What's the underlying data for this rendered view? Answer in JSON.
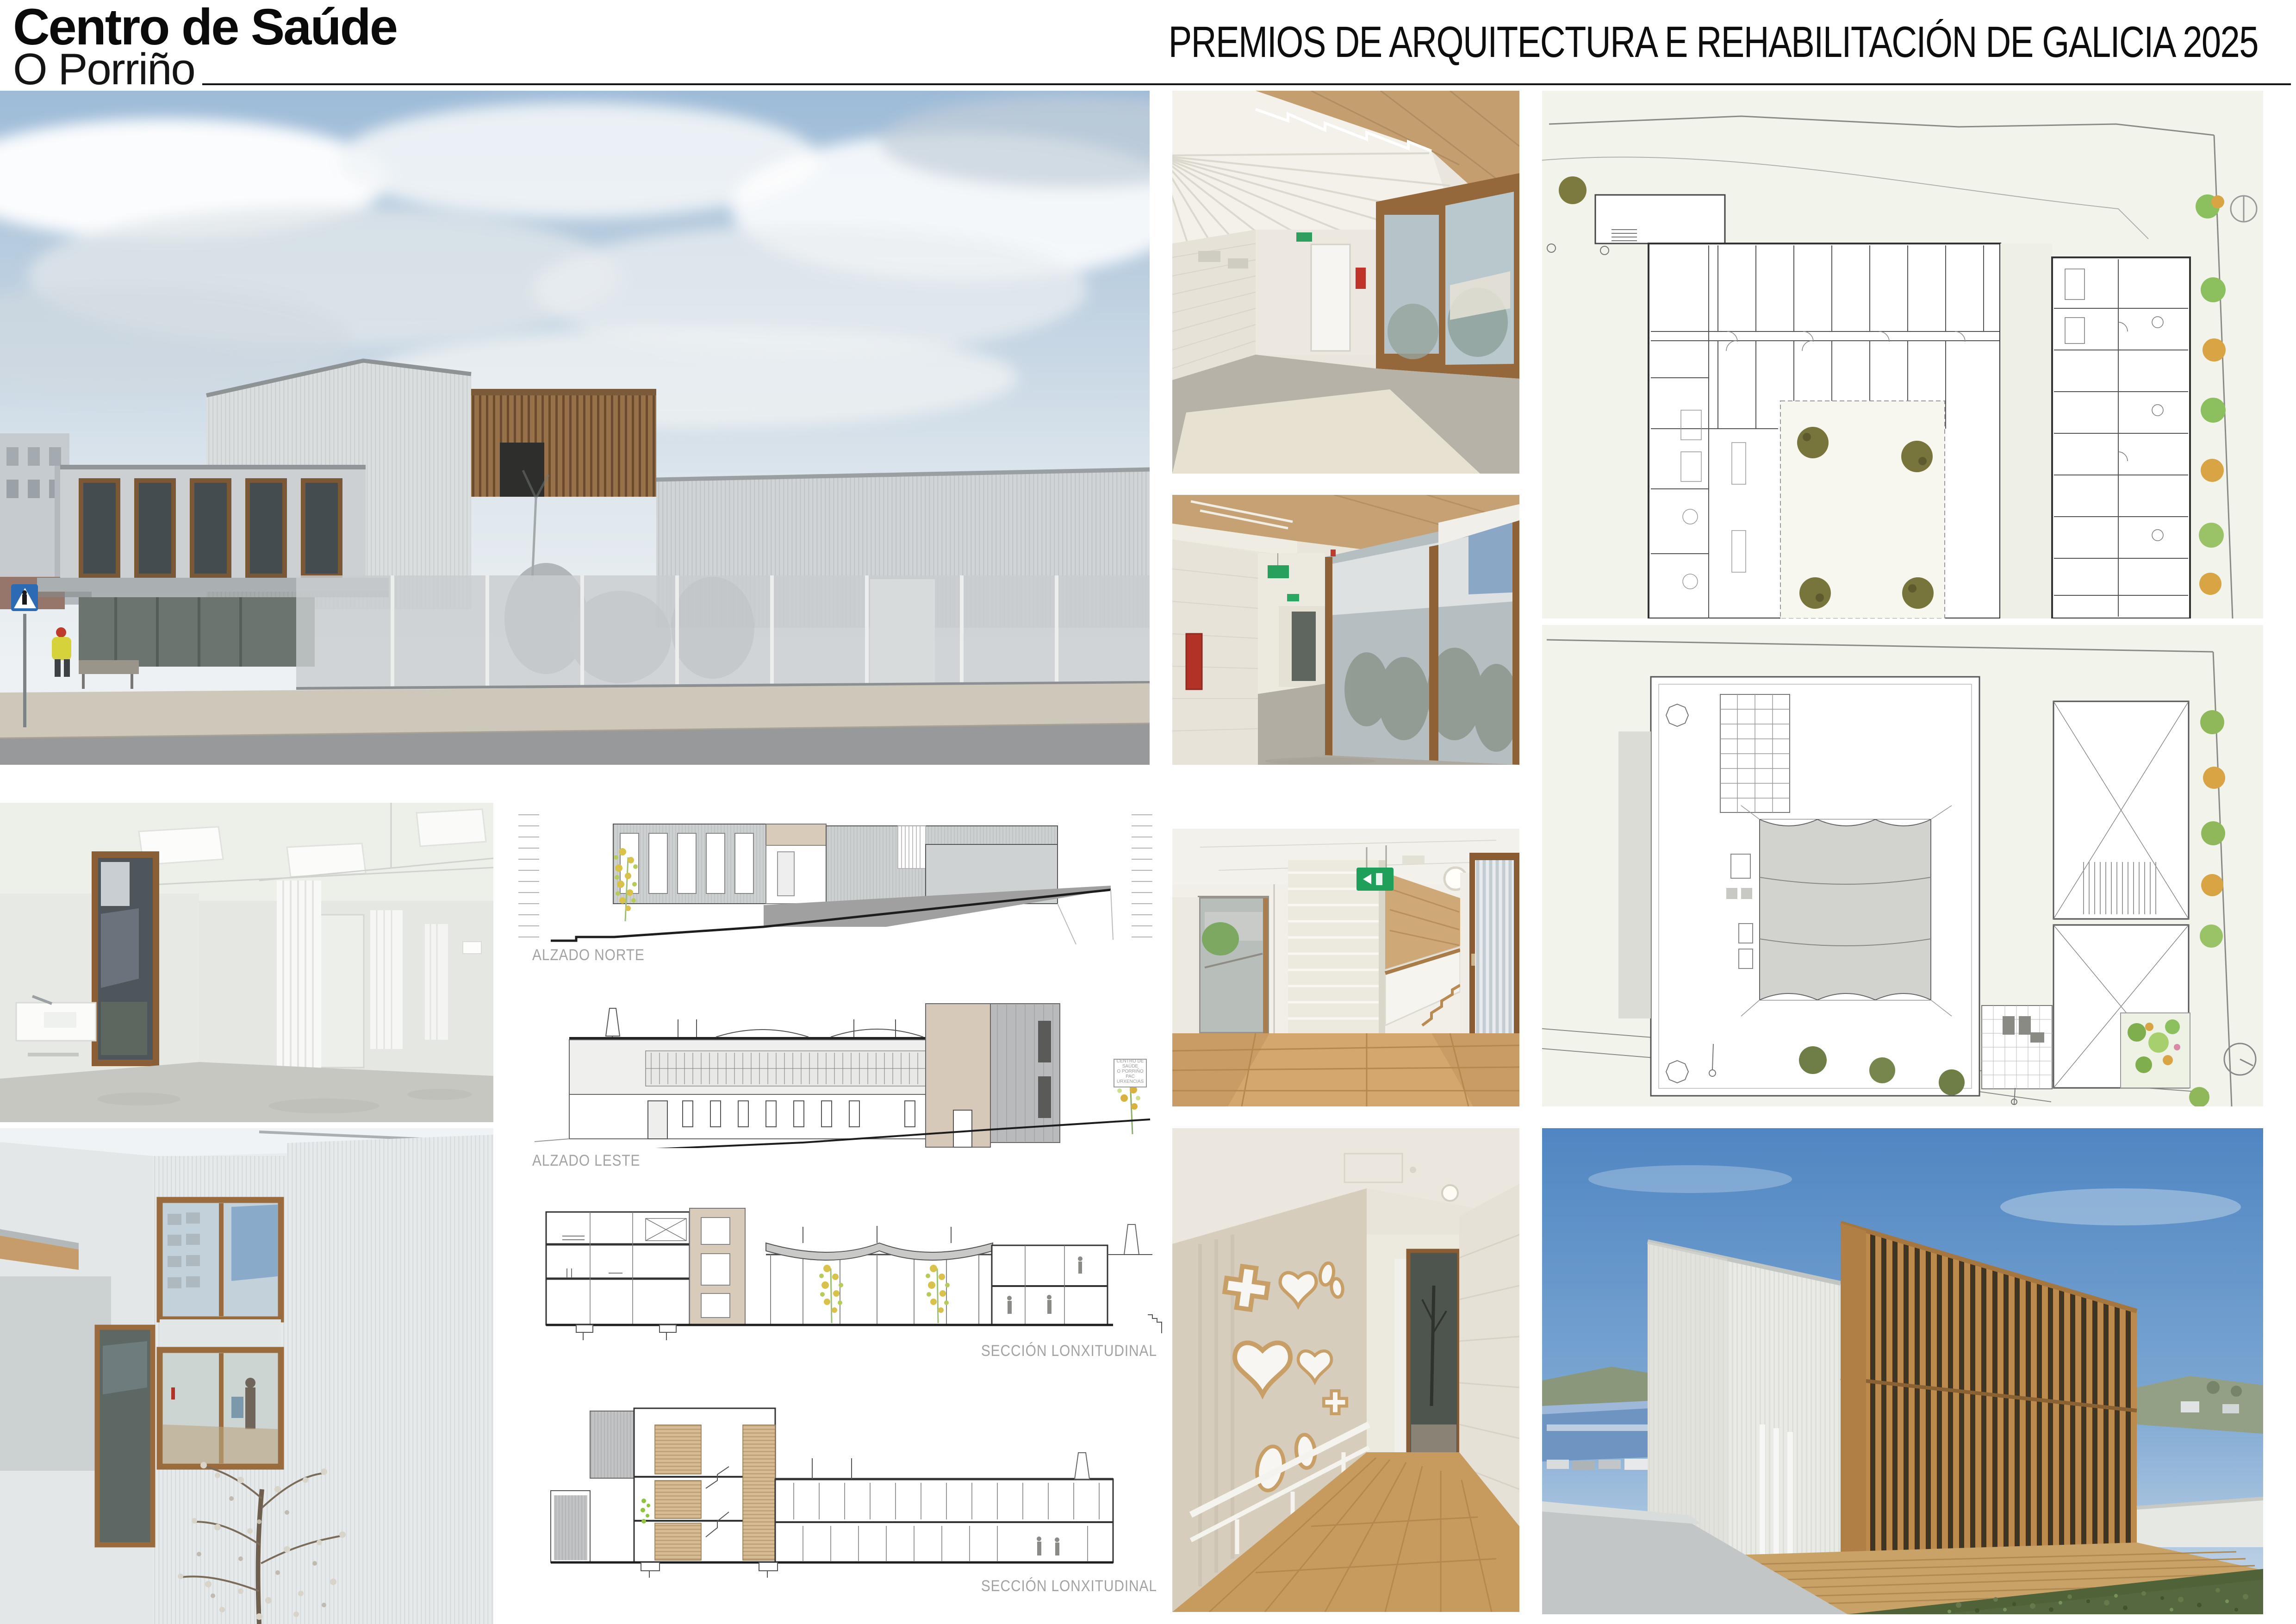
{
  "header": {
    "project_title": "Centro de Saúde",
    "project_subtitle": "O Porriño",
    "award_title": "PREMIOS DE ARQUITECTURA E REHABILITACIÓN DE GALICIA 2025"
  },
  "project_info": {
    "rows": [
      {
        "label": "Situación",
        "value": "_ Rúa Tranvía, s/n. O Porriño (Pontevedra)",
        "bold": true
      },
      {
        "label": "Superficie",
        "value": "_ 2.703 m²",
        "bold": true
      },
      {
        "label": "Finalización",
        "value": "_outubro de 2023",
        "bold": true
      },
      {
        "label": "PEM",
        "value": "_ 4.007.237 €",
        "bold": true
      },
      {
        "label": "Promotor",
        "value": "_SERGAS Servicio Galego de Saúde",
        "bold": true
      },
      {
        "label": "Autoras",
        "value": "_Cristina Ezcurra, Cristina Ouzande",
        "bold": true
      },
      {
        "label": "Colaboradores",
        "value": "_Sandra Arcos, Belén Riande, Julio Pedreira, Néstor Rancaño",
        "bold": true
      },
      {
        "label": "Cálculo estructuras",
        "value": "_David Robles Redondo, Veta Ingeniería",
        "bold": true
      },
      {
        "label": "Enxeñería de instalacións",
        "value": "_Nortap Ingenieros S.L.",
        "bold": false
      },
      {
        "label": "Enxeñería telecomunicacións",
        "value": "_Gehon Consulting S.L.",
        "bold": false
      },
      {
        "label": "Dirección de obra",
        "value": "_Cristina Ezcurra, Cristina Ouzande",
        "bold": true
      },
      {
        "label": "Dirección de execución",
        "value": "_Antonio Carballo Couñago",
        "bold": true
      },
      {
        "label": "Coordinador de Seguridad y Salud",
        "value": "_Luis Ángel Fernández Neira",
        "bold": false
      },
      {
        "label": "Constructora",
        "value": "_COPASA",
        "bold": true
      }
    ]
  },
  "drawing_labels": {
    "alzado_norte": "ALZADO NORTE",
    "alzado_leste": "ALZADO LESTE",
    "seccion_1": "SECCIÓN LONXITUDINAL",
    "seccion_2": "SECCIÓN LONXITUDINAL"
  },
  "leste_sign": {
    "lines": [
      "CENTRO DE",
      "SAÚDE",
      "O PORRIÑO",
      "PAC",
      "URXENCIAS"
    ]
  },
  "colors": {
    "exit_sign_green": "#1fa05a",
    "fire_equipment_red": "#bf3328",
    "timber_wood": "#b9854a",
    "sky_blue": "#5b8fc7",
    "plan_site_green": "#f2f4ec",
    "drawing_label_gray": "#a3a3a3",
    "elevation_beige": "#d9cbb9",
    "corrugated_gray": "#cdd0d2"
  }
}
